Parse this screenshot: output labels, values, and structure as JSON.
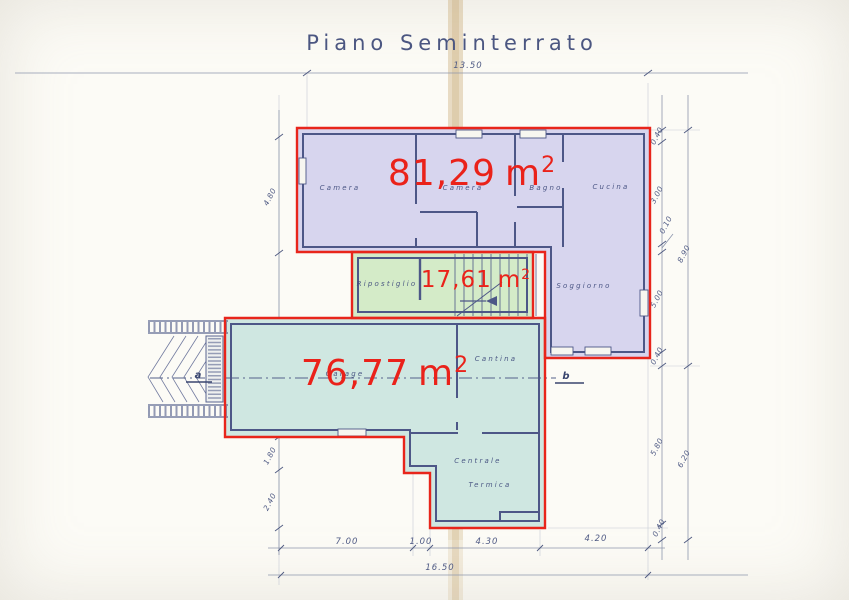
{
  "title": "Piano Seminterrato",
  "areas": {
    "purple": {
      "value": "81,29",
      "unit": "m",
      "sup": "2"
    },
    "green": {
      "value": "17,61",
      "unit": "m",
      "sup": "2"
    },
    "teal": {
      "value": "76,77",
      "unit": "m",
      "sup": "2"
    }
  },
  "rooms": {
    "camera_left": "Camera",
    "camera_mid": "Camera",
    "bagno": "Bagno",
    "cucina": "Cucina",
    "soggiorno": "Soggiorno",
    "ripostiglio": "Ripostiglio",
    "garage": "Garage",
    "cantina": "Cantina",
    "centrale_termica_line1": "Centrale",
    "centrale_termica_line2": "Termica"
  },
  "dimensions": {
    "top_total": "13.50",
    "bottom_segments": [
      "7.00",
      "1.00",
      "4.30",
      "4.20"
    ],
    "bottom_total": "16.50",
    "left_upper": "4.80",
    "left_lower": [
      "1.80",
      "2.40"
    ],
    "right_inner": [
      "0.40",
      "3.00",
      "0.10",
      "5.00",
      "0.40",
      "5.80",
      "0.40"
    ],
    "right_outer": [
      "8.90",
      "6.20"
    ]
  },
  "markers": {
    "a": "a",
    "b": "b"
  },
  "colors": {
    "annotation_red": "#e8251b",
    "purple_fill": "#d7d5ee",
    "green_fill": "#d4ebc8",
    "teal_fill": "#cfe7e1",
    "wall_ink": "#4d5787",
    "dimension_ink": "#5a6488",
    "paper": "#fcfbf6",
    "crease": "#c8a873"
  }
}
